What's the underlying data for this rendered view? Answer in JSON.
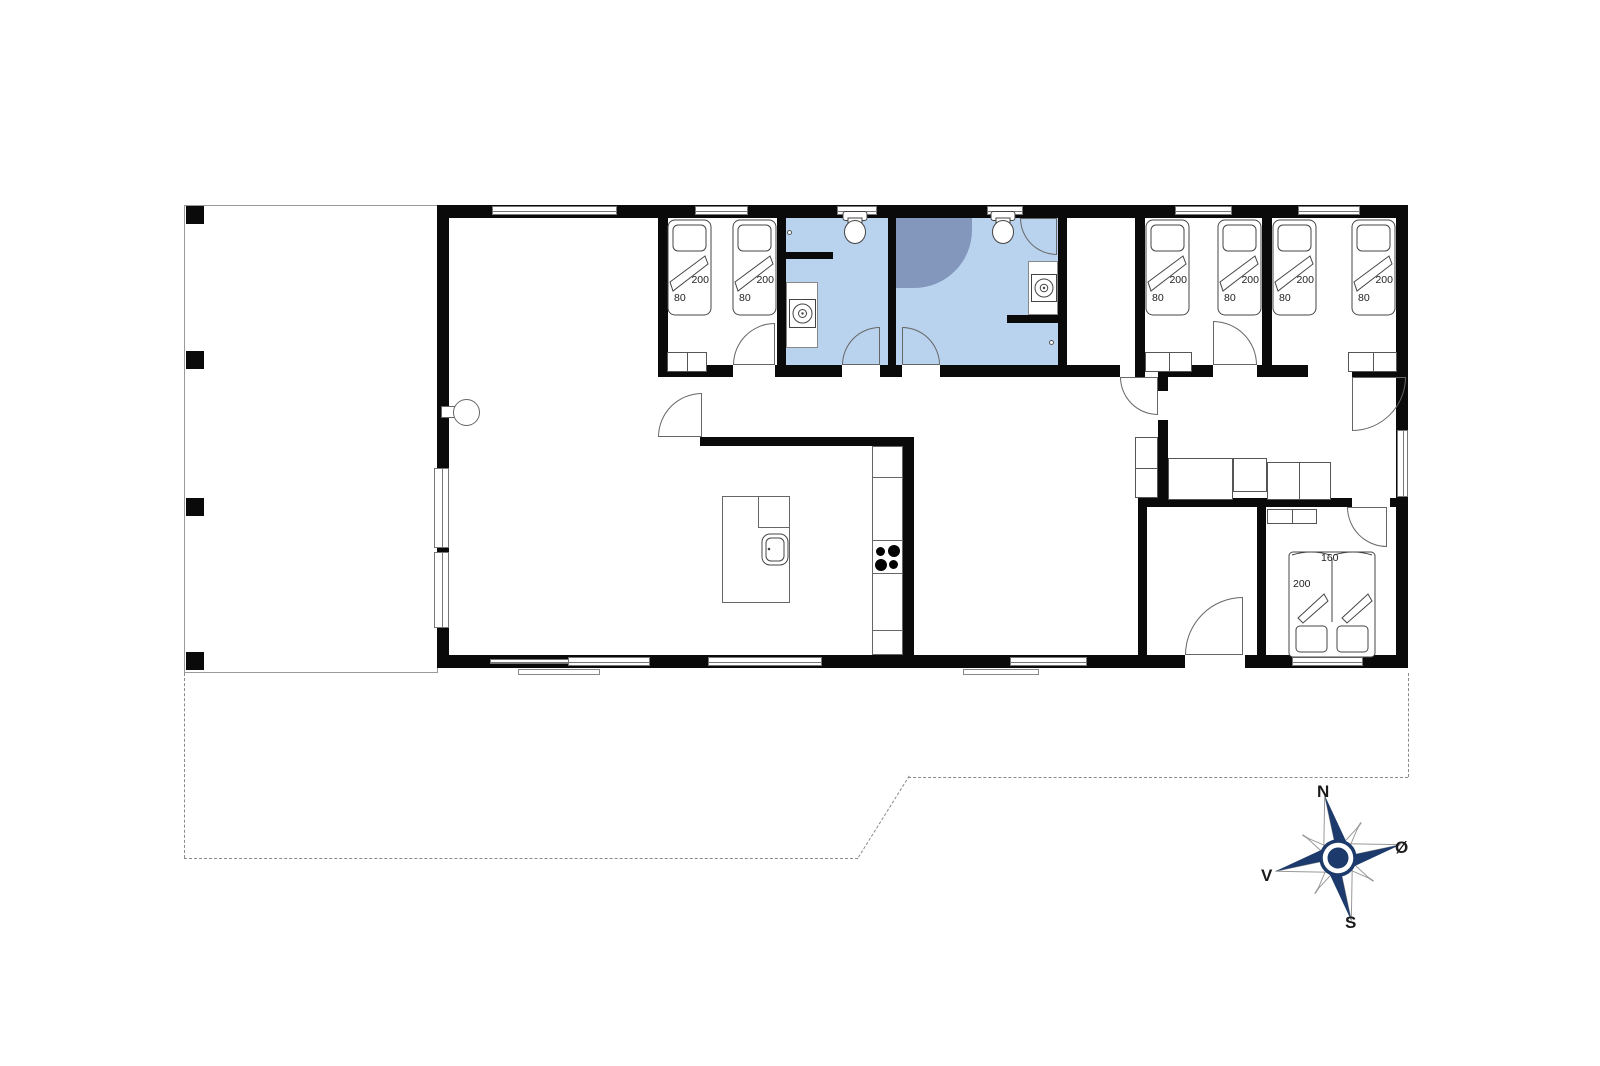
{
  "compass": {
    "north": "N",
    "east": "Ø",
    "south": "S",
    "west": "V"
  },
  "beds": {
    "single_length": "200",
    "single_width": "80",
    "double_width": "160",
    "double_length": "200"
  },
  "colors": {
    "wall": "#0a0a0a",
    "bathroom_fill": "#b9d3ee",
    "shower_fill": "#8397bd",
    "compass_navy": "#1c3a6b",
    "outline": "#555555",
    "dashed_line": "#8a8a8a"
  }
}
